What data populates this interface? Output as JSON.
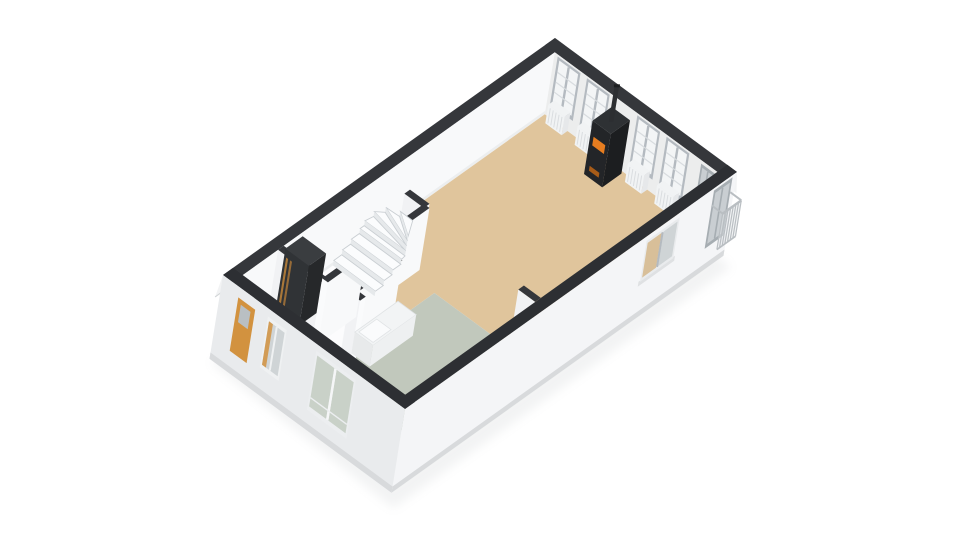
{
  "scene": {
    "canvas": {
      "w": 960,
      "h": 540,
      "background": "#ffffff"
    },
    "projection": {
      "origin": [
        213,
        337
      ],
      "ua": [
        33.2,
        -23.7
      ],
      "vb": [
        32.5,
        23.93
      ],
      "up": [
        10,
        -62
      ]
    },
    "building": {
      "length": 10,
      "width": 5.6,
      "ext_wall": 0.3,
      "int_wall_half": 0.085,
      "base_depth": -0.35
    },
    "colors": {
      "cap": "#35373b",
      "cap_near": "#2d2f33",
      "ext_band": "#f2f3f4",
      "ext_band_edge": "#d2d5d7",
      "ext_face_sw": "#e9ebed",
      "ext_face_se": "#f4f5f7",
      "plinth": "#d8dadc",
      "int_face_light": "#f8f9fa",
      "int_face_mid": "#f1f2f4",
      "int_face_dark": "#eceded",
      "int_face_end": "#fafbfc",
      "face_base_shadow": "#e9ebec",
      "floor_base": "#fcfcfd",
      "floor_living": "#e0c59c",
      "floor_kitchen": "#c1c8bc",
      "window_frame": "#b4bac0",
      "window_frame_light": "#e9ebed",
      "glazing": "#f3f5f6",
      "glazing_bar": "#d8dcdf",
      "glass_dark": "#cfd4d6",
      "glass_green": "#c9d1c8",
      "glass_tan": "#d8bf99",
      "recess_frame": "#a6adb2",
      "recess_inner": "#c9ced2",
      "radiator": "#f1f3f4",
      "radiator_side": "#e6e8ea",
      "radiator_slat": "#dadde0",
      "door_wood": "#d2923f",
      "doormat": "#d79b49",
      "wood_trim": "#b87f3a",
      "stove_body": "#232528",
      "stove_side": "#1c1e20",
      "stove_top": "#2e3134",
      "fire": "#e67d20",
      "fire_low": "#a85c18",
      "flue": "#2c2e31",
      "tread": "#fbfcfd",
      "tread_edge": "#c9ced2",
      "riser": "#e6e9eb",
      "counter_top": "#f2f4f5",
      "counter_front": "#e8eaeb",
      "counter_side": "#eef0f1",
      "counter_inset": "#fafbfc",
      "counter_inset_edge": "#e0e3e5",
      "unit_front": "#303336",
      "unit_side": "#26282a",
      "unit_top": "#3a3d40",
      "railing": "#b9bec2",
      "railing_panel": "#e3e6e8",
      "shadow": "#9aa0a4"
    },
    "rooms": [
      {
        "name": "living-room",
        "floor": "floor_living",
        "poly": [
          [
            4.55,
            0.3
          ],
          [
            9.7,
            0.3
          ],
          [
            9.7,
            5.3
          ],
          [
            4.3,
            5.3
          ],
          [
            4.3,
            2.42
          ],
          [
            3.05,
            2.42
          ],
          [
            3.05,
            1.62
          ],
          [
            4.55,
            1.62
          ]
        ]
      },
      {
        "name": "kitchen",
        "floor": "floor_kitchen",
        "poly": [
          [
            0.95,
            5.3
          ],
          [
            0.95,
            3.05
          ],
          [
            1.68,
            2.42
          ],
          [
            4.3,
            2.42
          ],
          [
            4.3,
            5.3
          ]
        ]
      }
    ],
    "interior_walls": [
      {
        "name": "stairwell-east-wall",
        "dir": "b",
        "pos": 4.55,
        "from": 1.02,
        "to": 1.62
      },
      {
        "name": "stairwell-south-wall",
        "dir": "a",
        "pos": 1.62,
        "from": 3.05,
        "to": 4.55
      },
      {
        "name": "stairwell-jog-wall",
        "dir": "b",
        "pos": 3.05,
        "from": 1.62,
        "to": 2.32
      },
      {
        "name": "kitchen-north-wall",
        "dir": "a",
        "pos": 2.32,
        "from": 1.65,
        "to": 3.05
      },
      {
        "name": "kitchen-return-wall",
        "dir": "b",
        "pos": 1.65,
        "from": 2.32,
        "to": 2.62
      },
      {
        "name": "closet-west-wall",
        "dir": "b",
        "pos": 1.45,
        "from": 0.3,
        "to": 1.66
      },
      {
        "name": "closet-south-wall",
        "dir": "a",
        "pos": 1.66,
        "from": 1.45,
        "to": 2.6
      }
    ],
    "stub_wall": {
      "name": "living-kitchen-stub-wall",
      "dir": "b",
      "pos": 4.3,
      "from": 4.78,
      "to": 5.3
    },
    "ne_windows": [
      {
        "b": [
          0.4,
          1.1
        ]
      },
      {
        "b": [
          1.3,
          2.0
        ]
      },
      {
        "b": [
          2.85,
          3.55
        ]
      },
      {
        "b": [
          3.75,
          4.45
        ]
      }
    ],
    "ne_corner_door": {
      "b": [
        4.82,
        5.26
      ]
    },
    "stove": {
      "a": [
        9.06,
        9.64
      ],
      "b": [
        2.16,
        2.72
      ],
      "h": 0.86,
      "flue_ab": [
        9.35,
        2.44
      ],
      "flue_top": 1.42
    },
    "stairs": {
      "b": [
        0.3,
        1.58
      ],
      "straight_a": [
        3.32,
        3.56,
        3.8,
        4.04
      ],
      "pivot": [
        4.16,
        1.56
      ],
      "fan_pts": [
        [
          4.16,
          0.3
        ],
        [
          4.38,
          0.34
        ],
        [
          4.53,
          0.52
        ],
        [
          4.55,
          0.92
        ],
        [
          4.55,
          1.3
        ]
      ],
      "rise": 0.08
    },
    "closet_unit": {
      "a": [
        1.56,
        2.08
      ],
      "b": [
        0.34,
        1.06
      ],
      "h": 0.96
    },
    "doormat": {
      "a": [
        0.32,
        0.72
      ],
      "b": [
        0.5,
        1.06
      ]
    },
    "counter": {
      "a": [
        1.78,
        3.08
      ],
      "b": [
        2.44,
        3.0
      ],
      "h": 0.34,
      "inset": {
        "a": [
          1.84,
          2.38
        ],
        "b": [
          2.5,
          2.94
        ]
      }
    },
    "sw_openings": [
      {
        "name": "front-door",
        "type": "wood_door",
        "b": [
          0.52,
          1.04
        ]
      },
      {
        "name": "hall-window",
        "type": "window",
        "b": [
          1.42,
          2.0
        ]
      },
      {
        "name": "kitchen-glass-doors",
        "type": "glass_doors",
        "b": [
          2.9,
          4.12
        ]
      }
    ],
    "se_openings": [
      {
        "name": "living-window-pair",
        "type": "window_pair",
        "a": [
          7.3,
          8.3
        ]
      },
      {
        "name": "balcony-door",
        "type": "glass_door",
        "a": [
          9.32,
          9.88
        ]
      }
    ],
    "balcony": {
      "a": [
        9.32,
        9.88
      ],
      "depth": 0.34,
      "h": [
        0.14,
        0.72
      ],
      "bars": 7
    }
  }
}
